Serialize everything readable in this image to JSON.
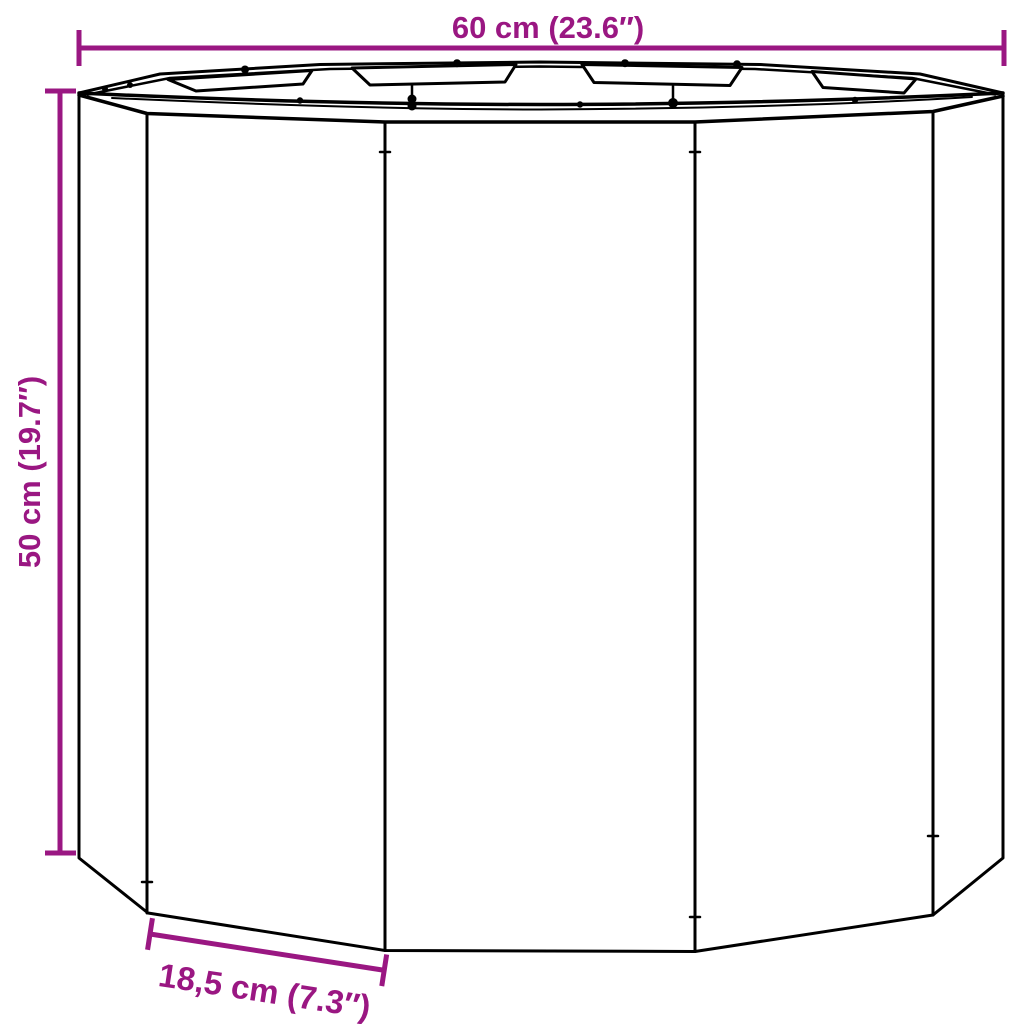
{
  "figure": {
    "type": "product-dimension-diagram",
    "subject": "dodecagonal-planter",
    "background_color": "#ffffff",
    "line_color": "#000000",
    "accent_color": "#9a1782"
  },
  "dimensions": {
    "width": {
      "label": "60 cm (23.6″)"
    },
    "height": {
      "label": "50 cm (19.7″)"
    },
    "panel": {
      "label": "18,5 cm (7.3″)"
    }
  }
}
